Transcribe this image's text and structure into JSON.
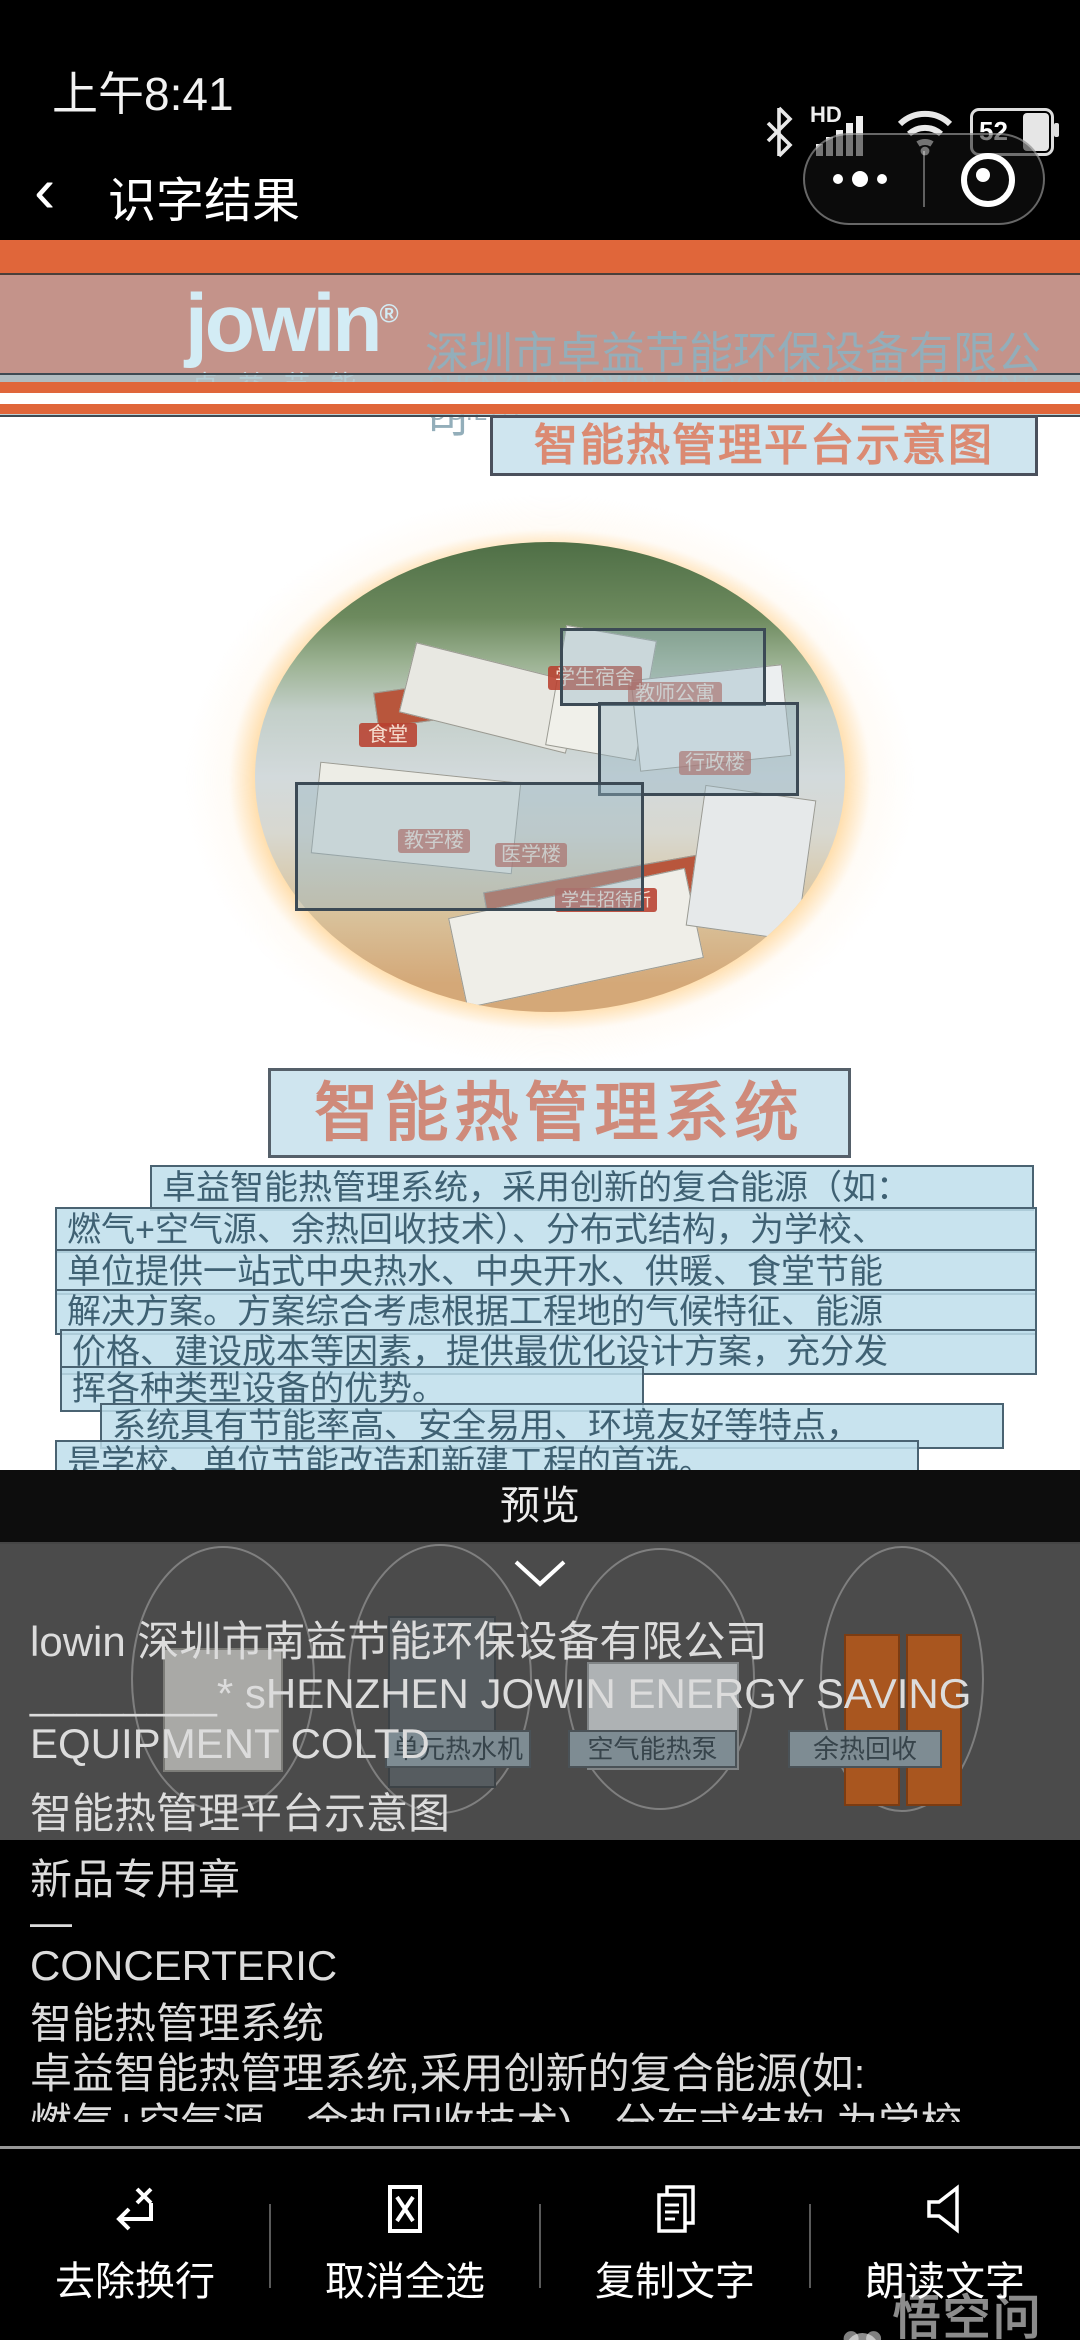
{
  "status_bar": {
    "time": "上午8:41",
    "network_label": "HD",
    "battery_percent": "52"
  },
  "nav": {
    "title": "识字结果"
  },
  "document": {
    "logo_text": "jowin",
    "logo_reg": "®",
    "logo_sub": "卓益节能",
    "company_cn": "深圳市卓益节能环保设备有限公司",
    "company_en": "SHENZHEN JOWIN ENERGY SAVING EQUIPMENT CO.LTD",
    "banner_title": "智能热管理平台示意图",
    "image_labels": [
      "食堂",
      "学生宿舍",
      "教师公寓",
      "行政楼",
      "教学楼",
      "医学楼",
      "学生招待所"
    ],
    "section_title": "智能热管理系统",
    "paragraph_lines": [
      "卓益智能热管理系统，采用创新的复合能源（如：",
      "燃气+空气源、余热回收技术）、分布式结构，为学校、",
      "单位提供一站式中央热水、中央开水、供暖、食堂节能",
      "解决方案。方案综合考虑根据工程地的气候特征、能源",
      "价格、建设成本等因素，提供最优化设计方案，充分发",
      "挥各种类型设备的优势。",
      "系统具有节能率高、安全易用、环境友好等特点，",
      "是学校、单位节能改造和新建工程的首选。"
    ],
    "product_labels": [
      "单元热水机",
      "空气能热泵",
      "余热回收"
    ]
  },
  "preview": {
    "title": "预览",
    "lines": [
      "lowin 深圳市南益节能环保设备有限公司",
      "________* sHENZHEN JOWIN ENERGY SAVING",
      "EQUIPMENT COLTD",
      "智能热管理平台示意图",
      "新品专用章",
      "—",
      "CONCERTERIC",
      "智能热管理系统",
      "卓益智能热管理系统,采用创新的复合能源(如:",
      "燃气+空气源、余热回收技术)、分布式结构,为学校"
    ]
  },
  "toolbar": {
    "items": [
      {
        "label": "去除换行",
        "icon": "remove-linebreak-icon"
      },
      {
        "label": "取消全选",
        "icon": "deselect-all-icon"
      },
      {
        "label": "复制文字",
        "icon": "copy-text-icon"
      },
      {
        "label": "朗读文字",
        "icon": "read-aloud-icon"
      }
    ]
  },
  "watermark": {
    "text": "悟空问答"
  },
  "colors": {
    "accent_orange": "#e0663a",
    "header_band_pink": "#c4938a",
    "selection_blue": "#bedeeb",
    "title_box_blue": "#cfe5ef",
    "title_text_salmon": "#db8a72",
    "chip_red": "#b8402f",
    "preview_dim_gray": "#4b4b4b"
  }
}
